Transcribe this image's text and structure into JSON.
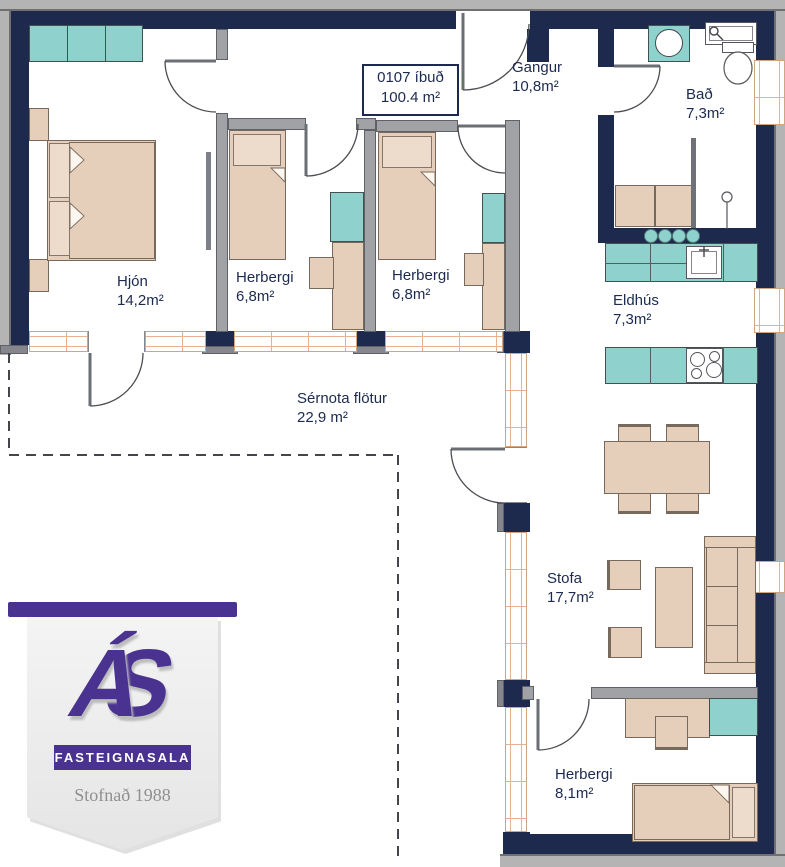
{
  "apartment": {
    "line1": "0107 íbuð",
    "line2": "100.4 m²"
  },
  "rooms": [
    {
      "name": "Hjón",
      "area": "14,2m²"
    },
    {
      "name": "Herbergi",
      "area": "6,8m²"
    },
    {
      "name": "Herbergi",
      "area": "6,8m²"
    },
    {
      "name": "Gangur",
      "area": "10,8m²"
    },
    {
      "name": "Bað",
      "area": "7,3m²"
    },
    {
      "name": "Eldhús",
      "area": "7,3m²"
    },
    {
      "name": "Sérnota flötur",
      "area": "22,9 m²"
    },
    {
      "name": "Stofa",
      "area": "17,7m²"
    },
    {
      "name": "Herbergi",
      "area": "8,1m²"
    }
  ],
  "logo": {
    "monogram_a": "Á",
    "monogram_s": "S",
    "label": "FASTEIGNASALA",
    "tagline": "Stofnað 1988"
  },
  "colors": {
    "wall_navy": "#1e2a4d",
    "interior_gray": "#a0a2a6",
    "furniture_beige": "#e6cfba",
    "cabinet_teal": "#8fd2cd",
    "window_peach": "#e7b292",
    "logo_purple": "#4a3291",
    "label_navy": "#1c2a50"
  }
}
